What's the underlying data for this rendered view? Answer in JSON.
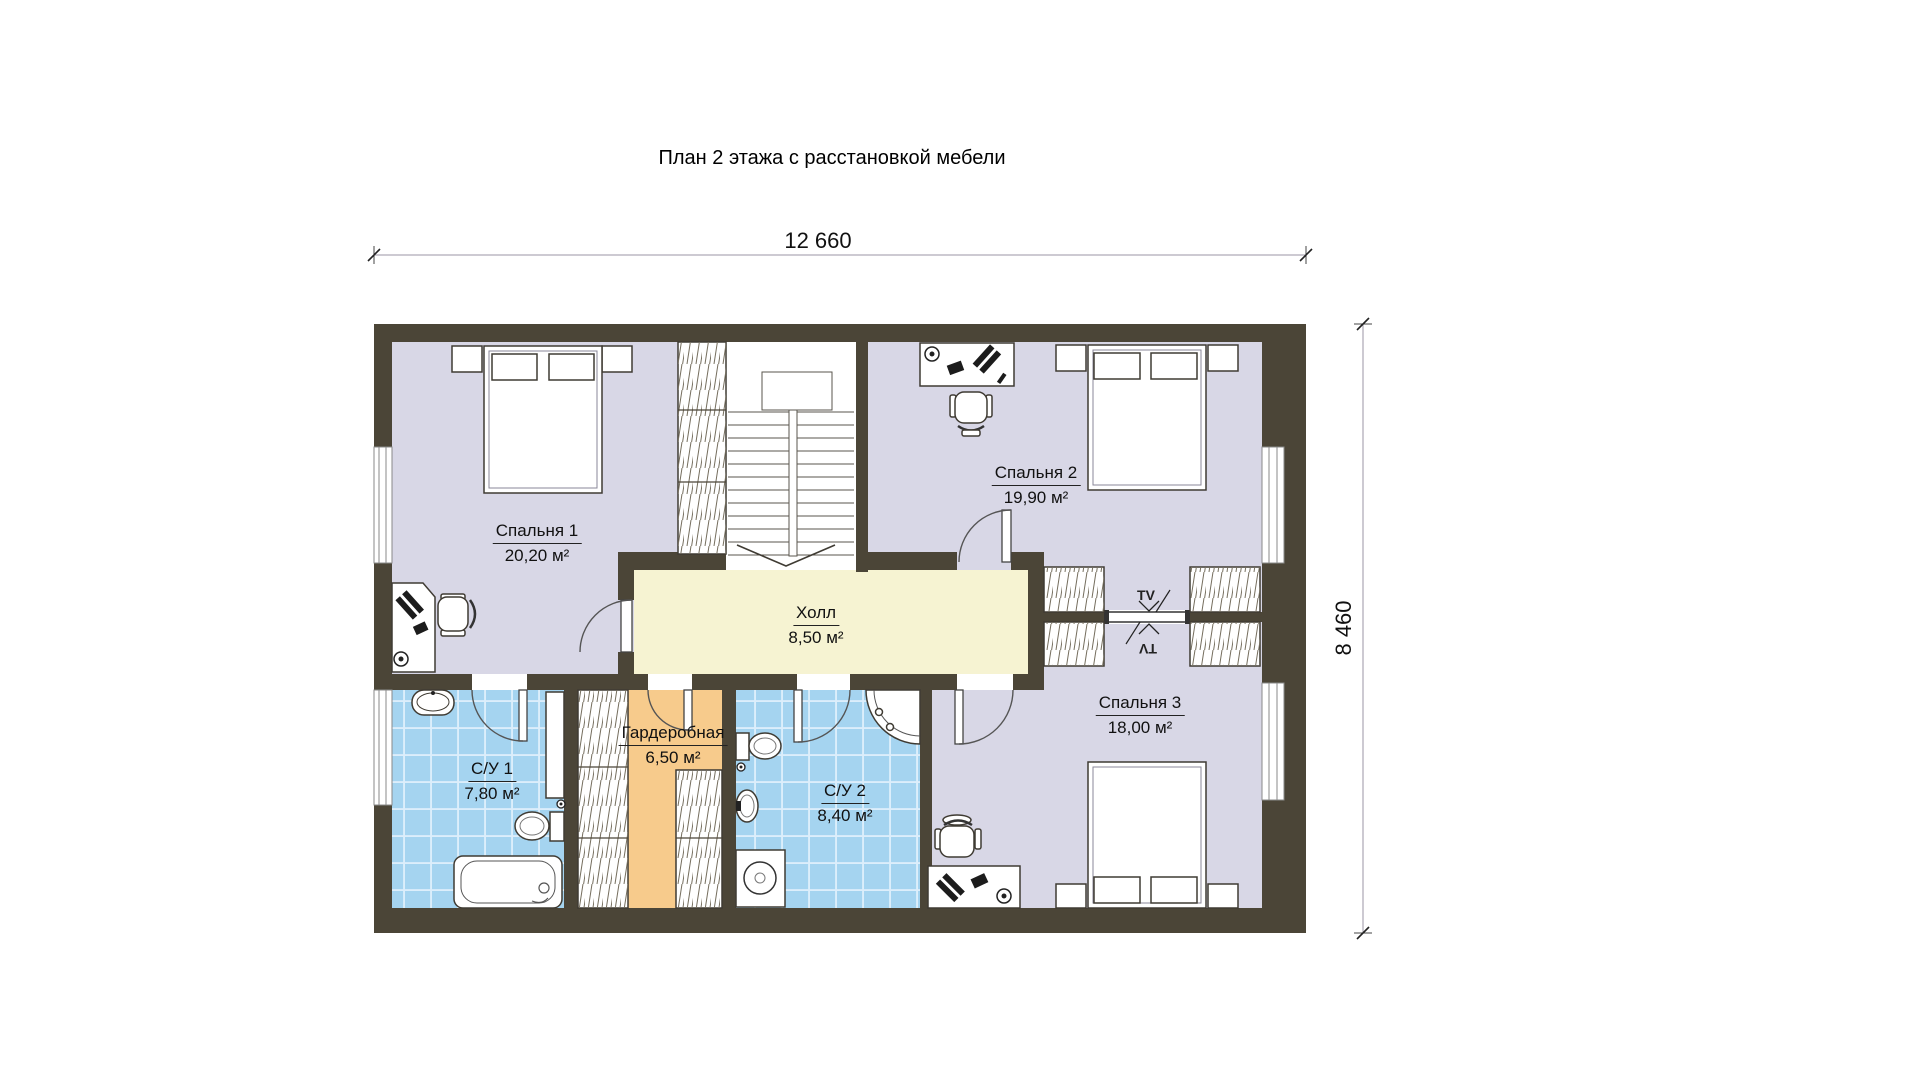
{
  "title": "План 2 этажа с расстановкой мебели",
  "dimensions": {
    "width": "12 660",
    "height": "8 460"
  },
  "rooms": {
    "bedroom1": {
      "name": "Спальня 1",
      "area": "20,20 м²"
    },
    "bedroom2": {
      "name": "Спальня 2",
      "area": "19,90 м²"
    },
    "bedroom3": {
      "name": "Спальня 3",
      "area": "18,00 м²"
    },
    "hall": {
      "name": "Холл",
      "area": "8,50 м²"
    },
    "bath1": {
      "name": "С/У 1",
      "area": "7,80 м²"
    },
    "bath2": {
      "name": "С/У 2",
      "area": "8,40 м²"
    },
    "dressing": {
      "name": "Гардеробная",
      "area": "6,50 м²"
    }
  },
  "labels": {
    "tv": "TV"
  },
  "colors": {
    "wall": "#4b4537",
    "bedroom": "#d8d7e6",
    "hall": "#f6f3d2",
    "bath": "#a5d4f0",
    "dressing": "#f7cb8c",
    "paper": "#ffffff",
    "ink": "#111111"
  }
}
